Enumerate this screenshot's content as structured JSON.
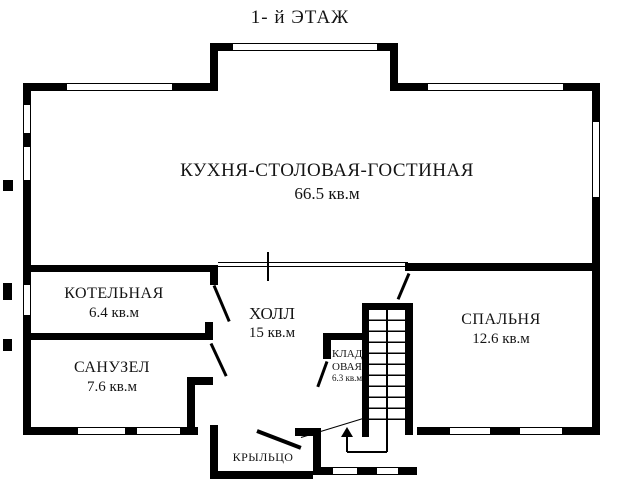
{
  "title": "1- й ЭТАЖ",
  "rooms": {
    "kitchen": {
      "name": "КУХНЯ-СТОЛОВАЯ-ГОСТИНАЯ",
      "area": "66.5 кв.м"
    },
    "boiler": {
      "name": "КОТЕЛЬНАЯ",
      "area": "6.4 кв.м"
    },
    "hall": {
      "name": "ХОЛЛ",
      "area": "15 кв.м"
    },
    "bathroom": {
      "name": "САНУЗЕЛ",
      "area": "7.6 кв.м"
    },
    "bedroom": {
      "name": "СПАЛЬНЯ",
      "area": "12.6 кв.м"
    },
    "storage": {
      "name_line1": "КЛАД",
      "name_line2": "ОВАЯ",
      "area": "6.3 кв.м"
    },
    "porch": {
      "name": "КРЫЛЬЦО"
    }
  },
  "colors": {
    "wall": "#000000",
    "background": "#ffffff",
    "text": "#141414"
  }
}
